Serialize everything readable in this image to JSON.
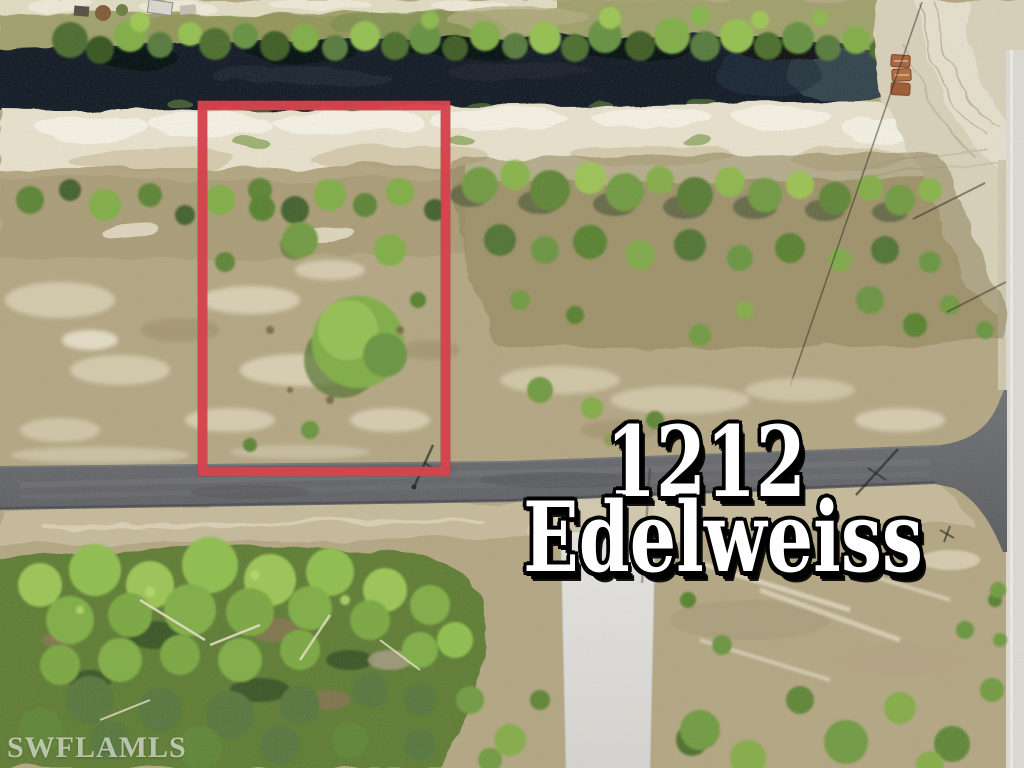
{
  "overlay": {
    "address_line1": "1212",
    "address_line2": "Edelweiss",
    "watermark": "SWFLAMLS"
  },
  "colors": {
    "boundary_red": "#d6434d",
    "boundary_deep": "#b2333c",
    "water_dark": "#0d1422",
    "water_steel": "#35464f",
    "sand_light": "#e8e2cd",
    "sand_mid": "#d8d1ba",
    "field_tan": "#b3a682",
    "scrub_tan": "#a89a74",
    "woods_green": "#5d7c33",
    "asphalt": "#616268",
    "concrete_light": "#e6e5e1",
    "text_white": "#ffffff",
    "text_black": "#000000"
  }
}
